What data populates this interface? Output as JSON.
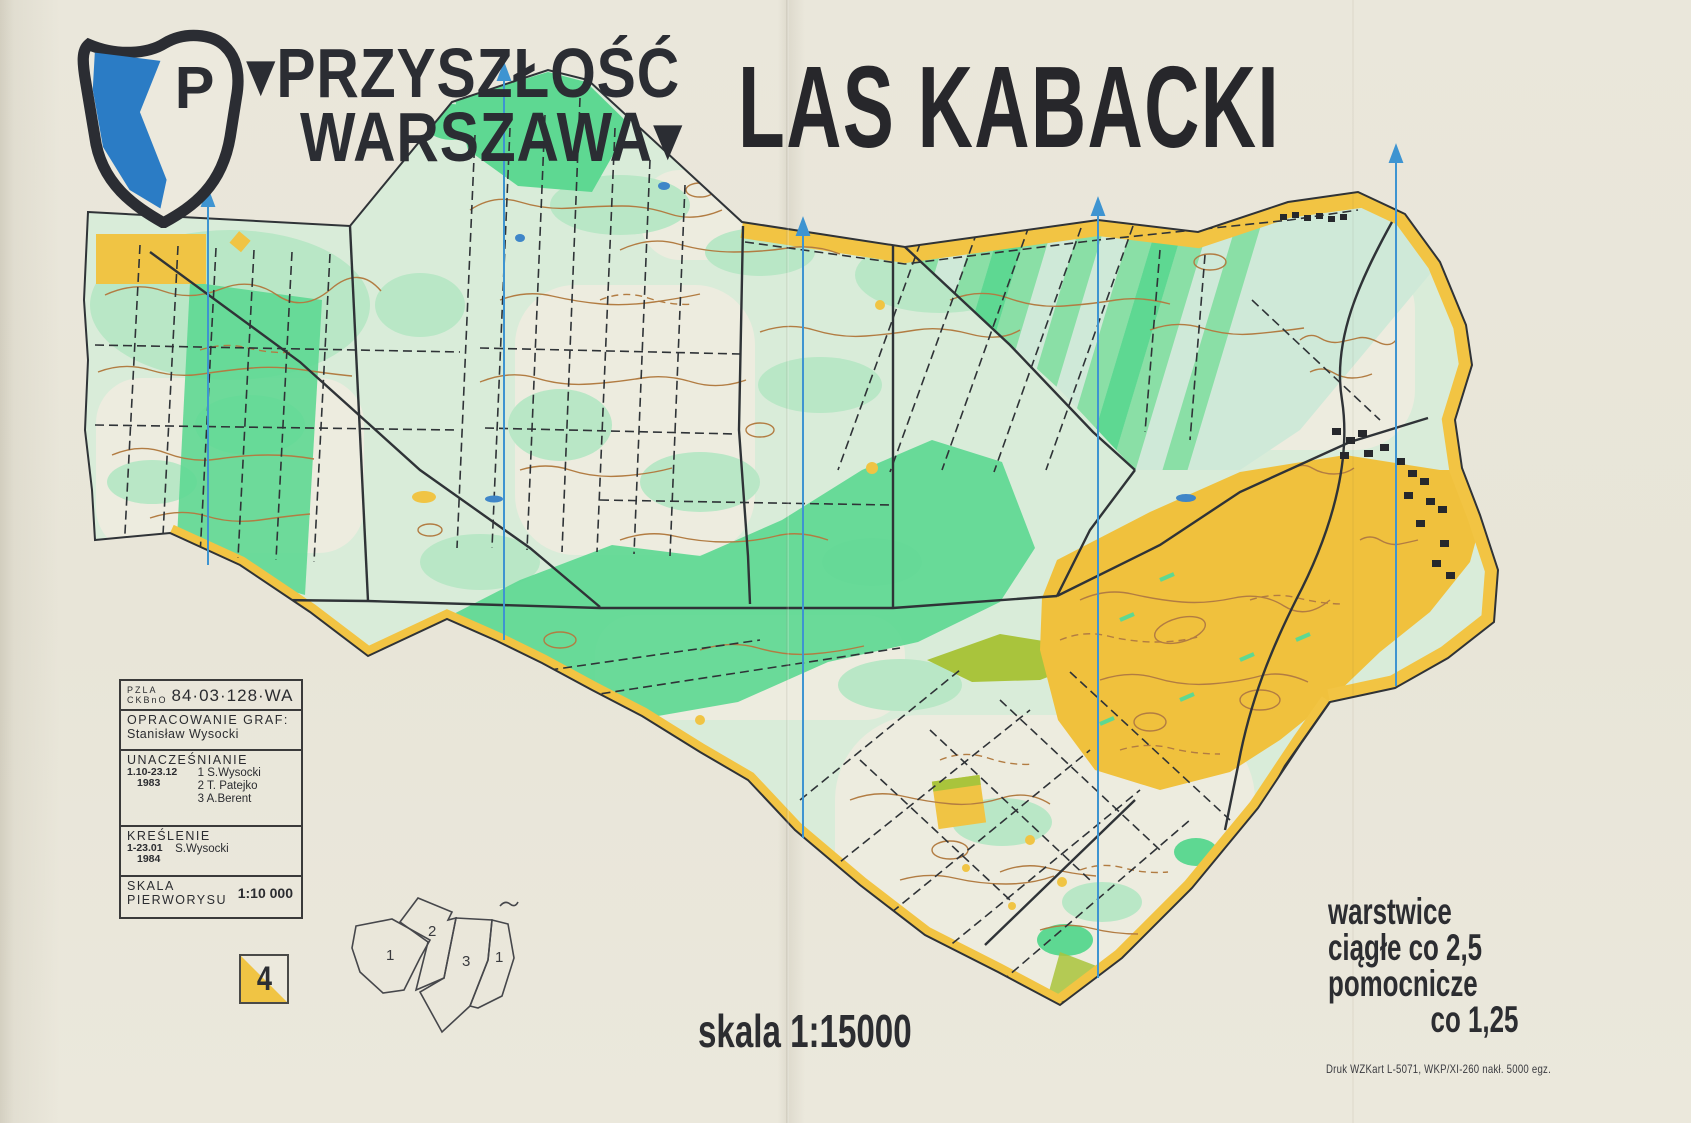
{
  "publisher": {
    "initial": "P",
    "line1": "▾PRZYSZŁOŚĆ",
    "line2": "WARSZAWA▾"
  },
  "title": "LAS KABACKI",
  "credits": {
    "org_line1": "PZLA",
    "org_line2": "CKBnO",
    "map_code": "84·03·128·WA",
    "graphics_label": "OPRACOWANIE GRAF:",
    "graphics_name": "Stanisław Wysocki",
    "update_label": "UNACZEŚNIANIE",
    "update_dates": "1.10-23.12",
    "update_year": "1983",
    "update_people": [
      "1 S.Wysocki",
      "2 T. Patejko",
      "3 A.Berent"
    ],
    "drawing_label": "KREŚLENIE",
    "drawing_dates": "1-23.01",
    "drawing_year": "1984",
    "drawing_name": "S.Wysocki",
    "base_scale_label1": "SKALA",
    "base_scale_label2": "PIERWORYSU",
    "base_scale_value": "1:10 000"
  },
  "sheet_number": "4",
  "index_map": {
    "labels": [
      "1",
      "2",
      "3",
      "1"
    ]
  },
  "scale_text": "skala 1:15000",
  "contours_note": {
    "line1": "warstwice",
    "line2": "ciągłe co 2,5",
    "line3": "pomocnicze",
    "line4": "co 1,25"
  },
  "print_note": "Druk WZKart L-5071, WKP/XI-260 nakł. 5000 egz.",
  "colors": {
    "paper": "#e8e5d8",
    "forest_white": "#edecdf",
    "vegetation_light_green": "#b9e7c6",
    "vegetation_bright_green": "#5ed892",
    "open_land_yellow": "#f0c444",
    "rough_open_olive": "#a9c43c",
    "contour_brown": "#b27c42",
    "line_black": "#2f3337",
    "north_line_blue": "#3e94d1",
    "water_blue": "#3f86c8",
    "logo_blue": "#2b7cc5",
    "text_dark": "#2b2c30"
  }
}
